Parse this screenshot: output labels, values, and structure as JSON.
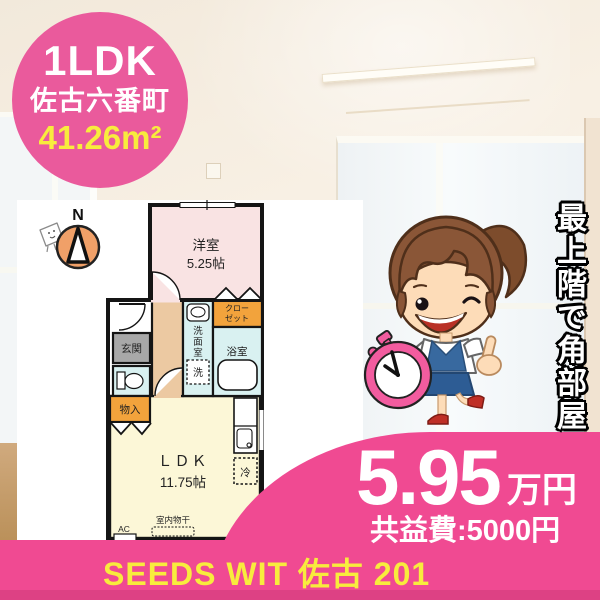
{
  "badge": {
    "layout": "1LDK",
    "town": "佐古六番町",
    "area": "41.26m²"
  },
  "floorplan": {
    "compass_n": "N",
    "western_room_label": "洋室",
    "western_room_size": "5.25帖",
    "closet_label_line1": "クロー",
    "closet_label_line2": "ゼット",
    "washroom_chars": [
      "洗",
      "面",
      "室"
    ],
    "washer_label": "洗",
    "bathroom_label": "浴室",
    "entrance_label": "玄関",
    "storage_label": "物入",
    "ldk_label": "ＬＤＫ",
    "ldk_size": "11.75帖",
    "fridge_label": "冷",
    "indoor_drying_label": "室内物干",
    "ac_label": "AC"
  },
  "mascot": {
    "vertical_catch": "最上階で角部屋"
  },
  "price": {
    "rent": "5.95",
    "unit": "万円",
    "common_fee": "共益費:5000円"
  },
  "footer": {
    "name": "SEEDS WIT 佐古 201"
  },
  "colors": {
    "main_pink": "#f04a92",
    "badge_pink": "#ea5a9c",
    "accent_yellow": "#f8ec3d",
    "compass_orange": "#f0a068",
    "closet_orange": "#f2a33c",
    "western_room_pink": "#f9e3e3",
    "wet_area_cyan": "#d9f1f1",
    "ldk_yellow": "#fcf7d7",
    "hallway_tan": "#ecc9a2"
  }
}
